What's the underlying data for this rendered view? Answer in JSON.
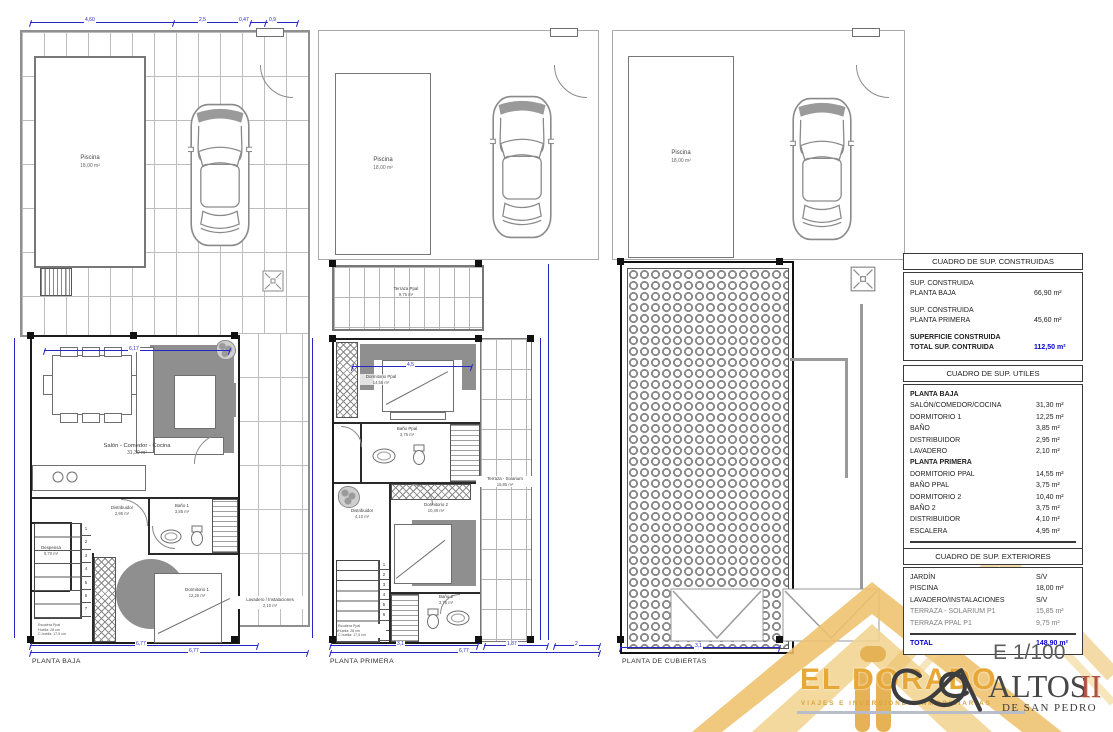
{
  "colors": {
    "dim_blue": "#2626c8",
    "total_blue": "#0000cc",
    "gold": "#e8a838",
    "brick_red": "#b0523c"
  },
  "plans": [
    {
      "name": "PLANTA BAJA",
      "pool": {
        "label": "Piscina",
        "area": "18,00 m²"
      },
      "rooms": {
        "salon": {
          "label": "Salón - Comedor - Cocina",
          "area": "31,30 m²"
        },
        "distribuidor": {
          "label": "Distribuidor",
          "area": "2,95 m²"
        },
        "bano1": {
          "label": "Baño 1",
          "area": "3,85 m²"
        },
        "despensa": {
          "label": "Despensa",
          "area": "0,70 m²"
        },
        "dormitorio1": {
          "label": "Dormitorio 1",
          "area": "12,25 m²"
        },
        "lavadero": {
          "label": "Lavadero / Instalaciones",
          "area": "2,10 m²"
        }
      },
      "stairs": [
        "1",
        "2",
        "3",
        "4",
        "5",
        "6",
        "7"
      ],
      "stair_note": [
        "Escalera Ppal",
        "Huella: 28 cm",
        "C.huella: 17,5 cm"
      ],
      "dims": {
        "top": [
          "4,60",
          "2,5",
          "0,47",
          "0,9"
        ],
        "inner_top": "6,17",
        "bottom1": "6,77",
        "bottom2": "6,77"
      }
    },
    {
      "name": "PLANTA PRIMERA",
      "pool": {
        "label": "Piscina",
        "area": "18,00 m²"
      },
      "rooms": {
        "terraza": {
          "label": "Terraza Ppal",
          "area": "9,75 m²"
        },
        "dorm_ppal": {
          "label": "Dormitorio Ppal",
          "area": "14,55 m²"
        },
        "bano_ppal": {
          "label": "Baño Ppal",
          "area": "3,75 m²"
        },
        "distribuidor": {
          "label": "Distribuidor",
          "area": "4,10 m²"
        },
        "dorm2": {
          "label": "Dormitorio 2",
          "area": "10,40 m²"
        },
        "bano2": {
          "label": "Baño 2",
          "area": "3,75 m²"
        },
        "solarium": {
          "label": "Terraza - Solarium",
          "area": "15,85 m²"
        }
      },
      "stairs": [
        "1",
        "2",
        "3",
        "4",
        "5",
        "6",
        "7",
        "8"
      ],
      "stair_note": [
        "Escalera Ppal",
        "Huella: 28 cm",
        "C.huella: 17,5 cm"
      ],
      "dims": {
        "inner_top": "4,5",
        "bottom_segs": [
          "3,1",
          "1,87",
          "2"
        ],
        "bottom": "6,77"
      }
    },
    {
      "name": "PLANTA DE CUBIERTAS",
      "pool": {
        "label": "Piscina",
        "area": "18,00 m²"
      },
      "dims": {
        "bottom": "3,1"
      }
    }
  ],
  "tables": {
    "construidas": {
      "title": "CUADRO DE SUP. CONSTRUIDAS",
      "rows": [
        {
          "l1": "SUP. CONSTRUIDA",
          "l2": "PLANTA BAJA",
          "v": "66,90 m²"
        },
        {
          "l1": "SUP. CONSTRUIDA",
          "l2": "PLANTA PRIMERA",
          "v": "45,60 m²"
        }
      ],
      "total": {
        "l1": "SUPERFICIE CONSTRUIDA",
        "l2": "TOTAL SUP. CONTRUIDA",
        "v": "112,50 m²"
      }
    },
    "utiles": {
      "title": "CUADRO DE SUP. UTILES",
      "rows": [
        {
          "label": "PLANTA BAJA",
          "v": ""
        },
        {
          "label": "SALÓN/COMEDOR/COCINA",
          "v": "31,30 m²"
        },
        {
          "label": "DORMITORIO 1",
          "v": "12,25 m²"
        },
        {
          "label": "BAÑO",
          "v": "3,85 m²"
        },
        {
          "label": "DISTRIBUIDOR",
          "v": "2,95 m²"
        },
        {
          "label": "LAVADERO",
          "v": "2,10 m²"
        },
        {
          "label": "PLANTA PRIMERA",
          "v": ""
        },
        {
          "label": "DORMITORIO PPAL",
          "v": "14,55 m²"
        },
        {
          "label": "BAÑO PPAL",
          "v": "3,75 m²"
        },
        {
          "label": "DORMITORIO 2",
          "v": "10,40 m²"
        },
        {
          "label": "BAÑO 2",
          "v": "3,75 m²"
        },
        {
          "label": "DISTRIBUIDOR",
          "v": "4,10 m²"
        },
        {
          "label": "ESCALERA",
          "v": "4,95 m²"
        }
      ],
      "total": {
        "label": "TOTAL",
        "v": "93,95 m²"
      }
    },
    "exteriores": {
      "title": "CUADRO DE SUP. EXTERIORES",
      "rows": [
        {
          "label": "JARDÍN",
          "v": "S/V"
        },
        {
          "label": "PISCINA",
          "v": "18,00 m²"
        },
        {
          "label": "LAVADERO/INSTALACIONES",
          "v": "S/V"
        },
        {
          "label": "TERRAZA - SOLARIUM P1",
          "v": "15,85 m²"
        },
        {
          "label": "TERRAZA PPAL P1",
          "v": "9,75 m²"
        }
      ],
      "total": {
        "label": "TOTAL",
        "v": "148,90 m²"
      }
    }
  },
  "branding": {
    "scale": "E 1/100",
    "eldorado": {
      "name": "EL DORADO",
      "tagline": "VIAJES E INVERSIONES INMOBILIARIAS"
    },
    "altos": {
      "name": "ALTOS",
      "numeral": "II",
      "sub": "DE SAN PEDRO"
    }
  }
}
